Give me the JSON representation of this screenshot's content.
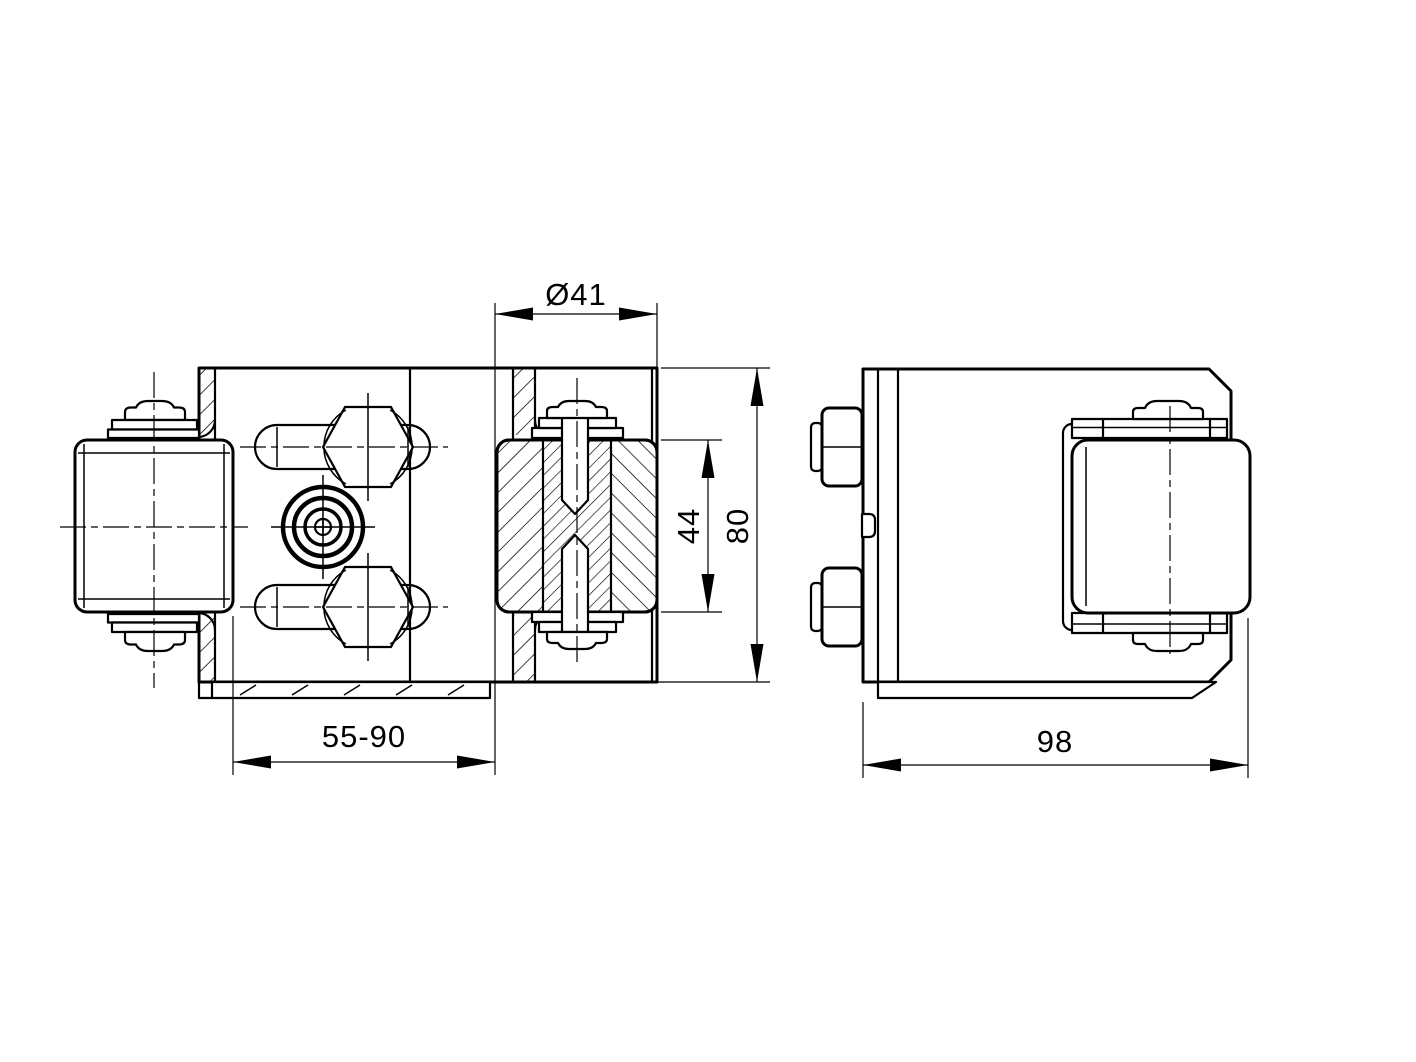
{
  "drawing": {
    "colors": {
      "ink": "#000000",
      "paper": "#ffffff"
    },
    "dimensions": {
      "roller_diameter": {
        "label": "Ø41"
      },
      "roller_width": {
        "label": "44"
      },
      "overall_height": {
        "label": "80"
      },
      "clamping_range": {
        "label": "55-90"
      },
      "overall_depth": {
        "label": "98"
      }
    }
  }
}
